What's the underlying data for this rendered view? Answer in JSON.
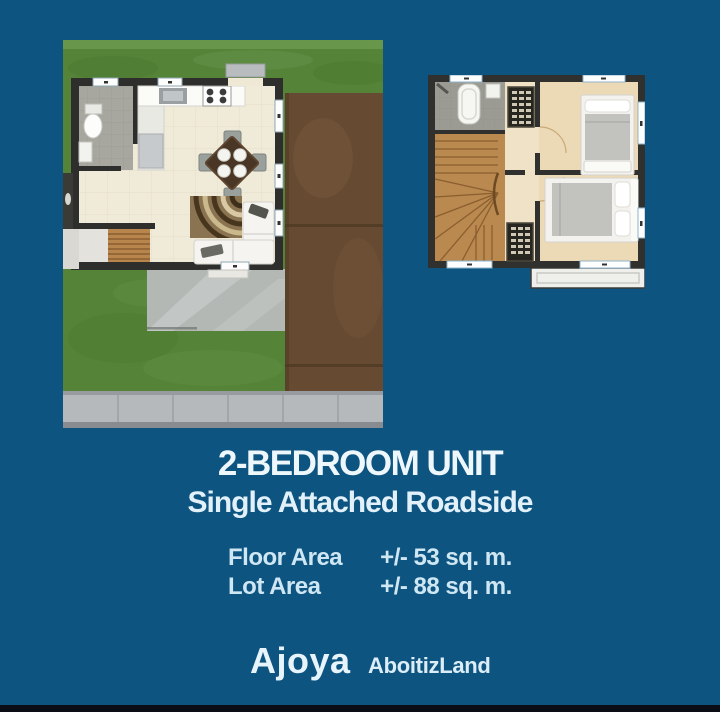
{
  "colors": {
    "background": "#0d5480",
    "footer_bar": "#0a0d16",
    "title_text": "#eef7fc",
    "spec_text": "#cfe7f3"
  },
  "title": "2-BEDROOM UNIT",
  "subtitle": "Single Attached Roadside",
  "specs": [
    {
      "label": "Floor Area",
      "value": "+/- 53 sq. m."
    },
    {
      "label": "Lot Area",
      "value": "+/- 88 sq. m."
    }
  ],
  "logos": {
    "ajoya": "Ajoya",
    "aboitizland": "AboitizLand"
  }
}
